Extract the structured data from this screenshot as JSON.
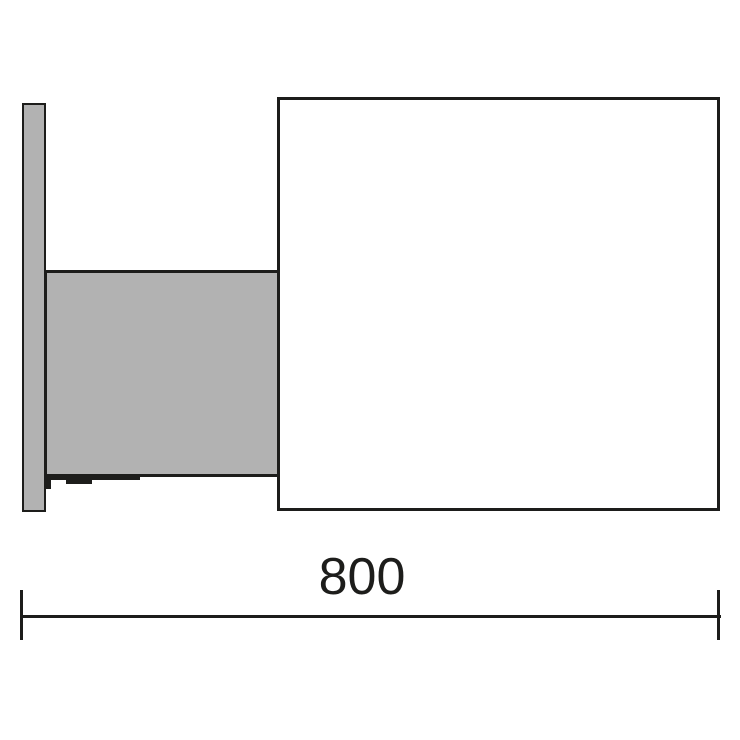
{
  "diagram": {
    "dimension_label": "800",
    "dimension_value": 800,
    "colors": {
      "outline": "#1d1d1b",
      "panel_fill": "#b2b2b2",
      "canvas": "#ffffff",
      "text": "#1d1d1b"
    }
  }
}
